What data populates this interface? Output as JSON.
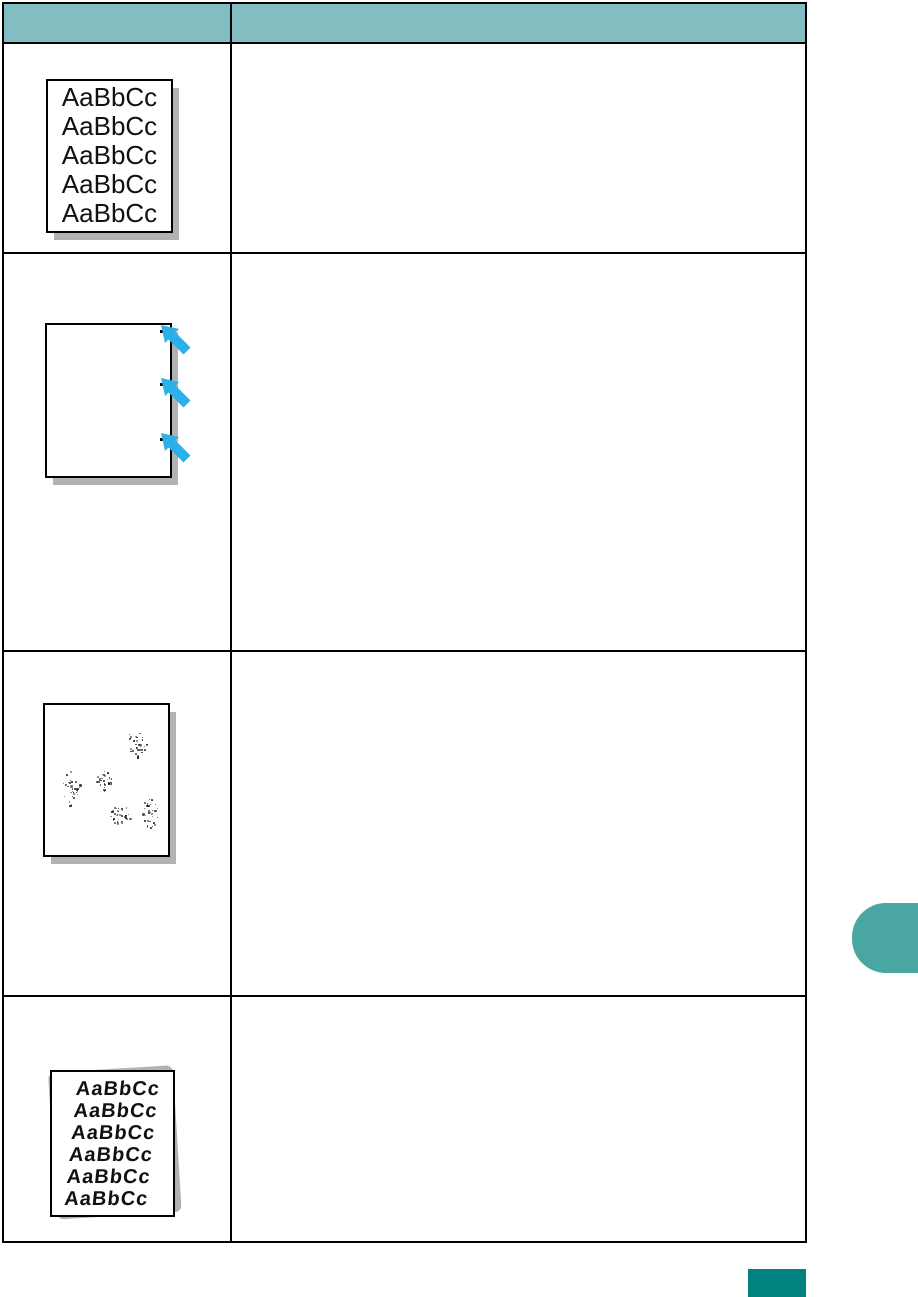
{
  "document": {
    "kind": "printer-manual-print-quality-table-page"
  },
  "table": {
    "columns": 2,
    "header": {
      "has_text": false
    },
    "rows": [
      {
        "sample": "misformed-characters",
        "sample_lines": [
          "AaBbCc",
          "AaBbCc",
          "AaBbCc",
          "AaBbCc",
          "AaBbCc"
        ],
        "solution_text": ""
      },
      {
        "sample": "vertical-repetitive-defects",
        "defect_mark_tops": [
          5,
          58,
          113
        ],
        "solution_text": ""
      },
      {
        "sample": "background-scatter",
        "clusters": [
          {
            "x": 92,
            "y": 37,
            "rx": 10,
            "ry": 16
          },
          {
            "x": 26,
            "y": 83,
            "rx": 9,
            "ry": 17
          },
          {
            "x": 59,
            "y": 75,
            "rx": 8,
            "ry": 10
          },
          {
            "x": 74,
            "y": 110,
            "rx": 12,
            "ry": 10
          },
          {
            "x": 105,
            "y": 107,
            "rx": 8,
            "ry": 17
          }
        ],
        "solution_text": ""
      },
      {
        "sample": "page-skew",
        "sample_lines": [
          "AaBbCc",
          "AaBbCc",
          "AaBbCc",
          "AaBbCc",
          "AaBbCc",
          "AaBbCc"
        ],
        "solution_text": ""
      }
    ]
  },
  "colors": {
    "header_teal": "#82bec1",
    "tab_teal": "#4aa6a3",
    "footer_teal": "#00827e",
    "arrow_cyan": "#2bb0e8",
    "shadow_gray": "#b2b2b2",
    "border_black": "#000000"
  }
}
